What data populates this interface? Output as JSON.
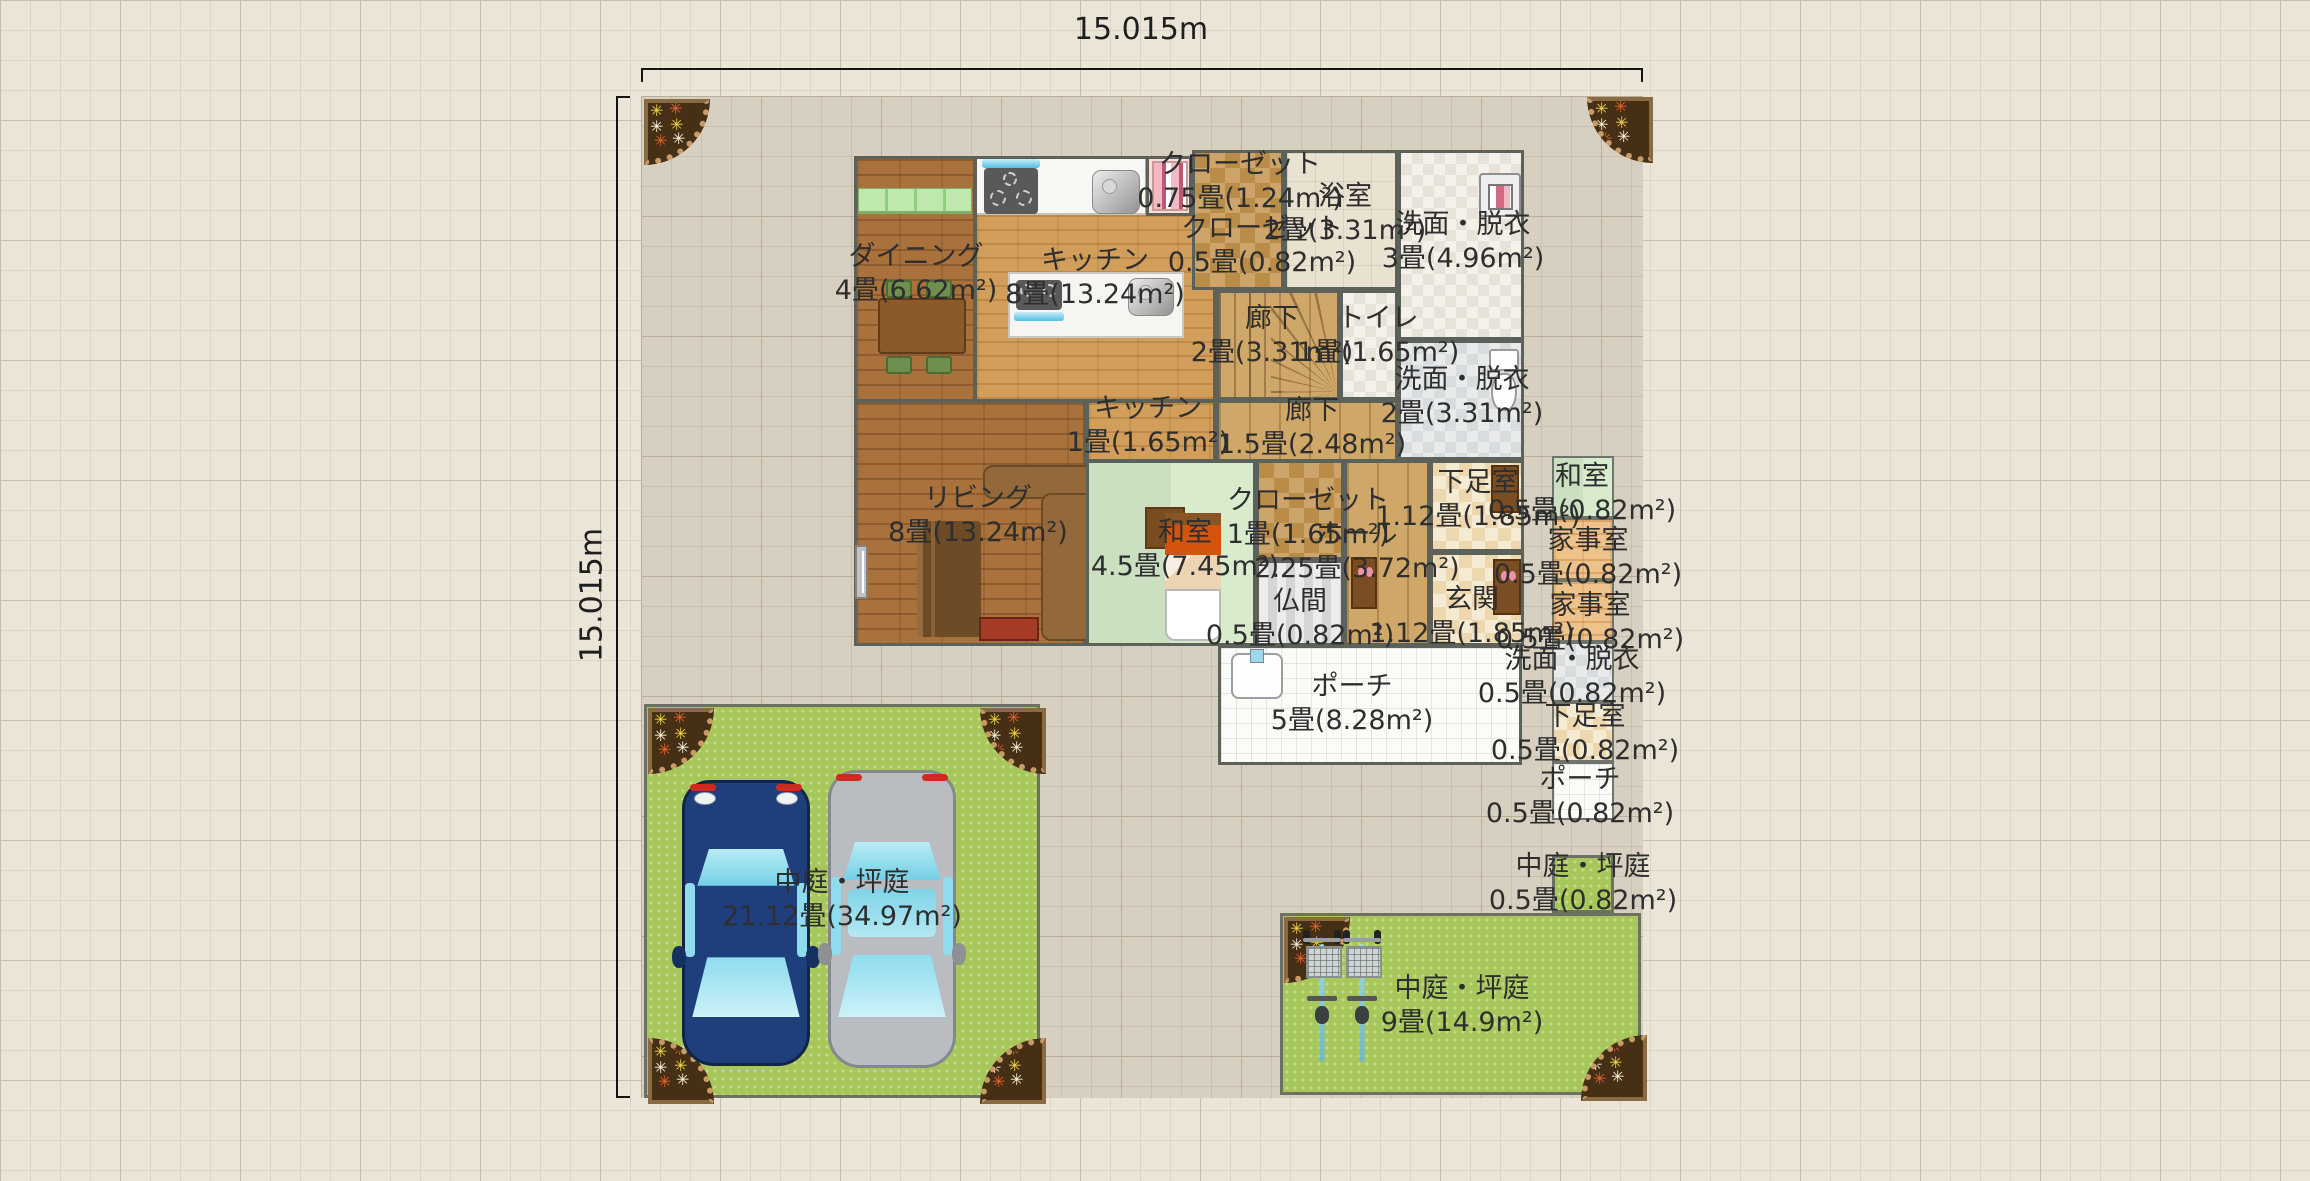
{
  "dimensions": {
    "width_label": "15.015m",
    "height_label": "15.015m"
  },
  "rooms": [
    {
      "name": "クローゼット",
      "size": "0.75畳(1.24m²)"
    },
    {
      "name": "浴室",
      "size": "2畳(3.31m²)"
    },
    {
      "name": "クローゼット",
      "size": "0.5畳(0.82m²)"
    },
    {
      "name": "洗面・脱衣",
      "size": "3畳(4.96m²)"
    },
    {
      "name": "ダイニング",
      "size": "4畳(6.62m²)"
    },
    {
      "name": "キッチン",
      "size": "8畳(13.24m²)"
    },
    {
      "name": "廊下",
      "size": "2畳(3.31m²)"
    },
    {
      "name": "トイレ",
      "size": "1畳(1.65m²)"
    },
    {
      "name": "洗面・脱衣",
      "size": "2畳(3.31m²)"
    },
    {
      "name": "キッチン",
      "size": "1畳(1.65m²)"
    },
    {
      "name": "廊下",
      "size": "1.5畳(2.48m²)"
    },
    {
      "name": "リビング",
      "size": "8畳(13.24m²)"
    },
    {
      "name": "和室",
      "size": "4.5畳(7.45m²)"
    },
    {
      "name": "クローゼット",
      "size": "1畳(1.65m²)"
    },
    {
      "name": "ホール",
      "size": "2.25畳(3.72m²)"
    },
    {
      "name": "下足室",
      "size": "1.12畳(1.85m²)"
    },
    {
      "name": "和室",
      "size": "0.5畳(0.82m²)"
    },
    {
      "name": "家事室",
      "size": "0.5畳(0.82m²)"
    },
    {
      "name": "玄関",
      "size": "1.12畳(1.85m²)"
    },
    {
      "name": "家事室",
      "size": "0.5畳(0.82m²)"
    },
    {
      "name": "仏間",
      "size": "0.5畳(0.82m²)"
    },
    {
      "name": "洗面・脱衣",
      "size": "0.5畳(0.82m²)"
    },
    {
      "name": "下足室",
      "size": "0.5畳(0.82m²)"
    },
    {
      "name": "ポーチ",
      "size": "5畳(8.28m²)"
    },
    {
      "name": "ポーチ",
      "size": "0.5畳(0.82m²)"
    },
    {
      "name": "中庭・坪庭",
      "size": "0.5畳(0.82m²)"
    },
    {
      "name": "中庭・坪庭",
      "size": "21.12畳(34.97m²)"
    },
    {
      "name": "中庭・坪庭",
      "size": "9畳(14.9m²)"
    }
  ],
  "colors": {
    "background_grid": "#ebe5d8",
    "site": "#d7cfbf",
    "garden_green": "#a8c75b",
    "brick_dark": "#a9713c",
    "brick_light": "#d19e5b",
    "wood": "#cfa768",
    "tatami_green": "#cfe3c4",
    "car_blue": "#1e3f7c",
    "car_silver": "#b9bcc0",
    "bed_accent": "#d4540e"
  }
}
